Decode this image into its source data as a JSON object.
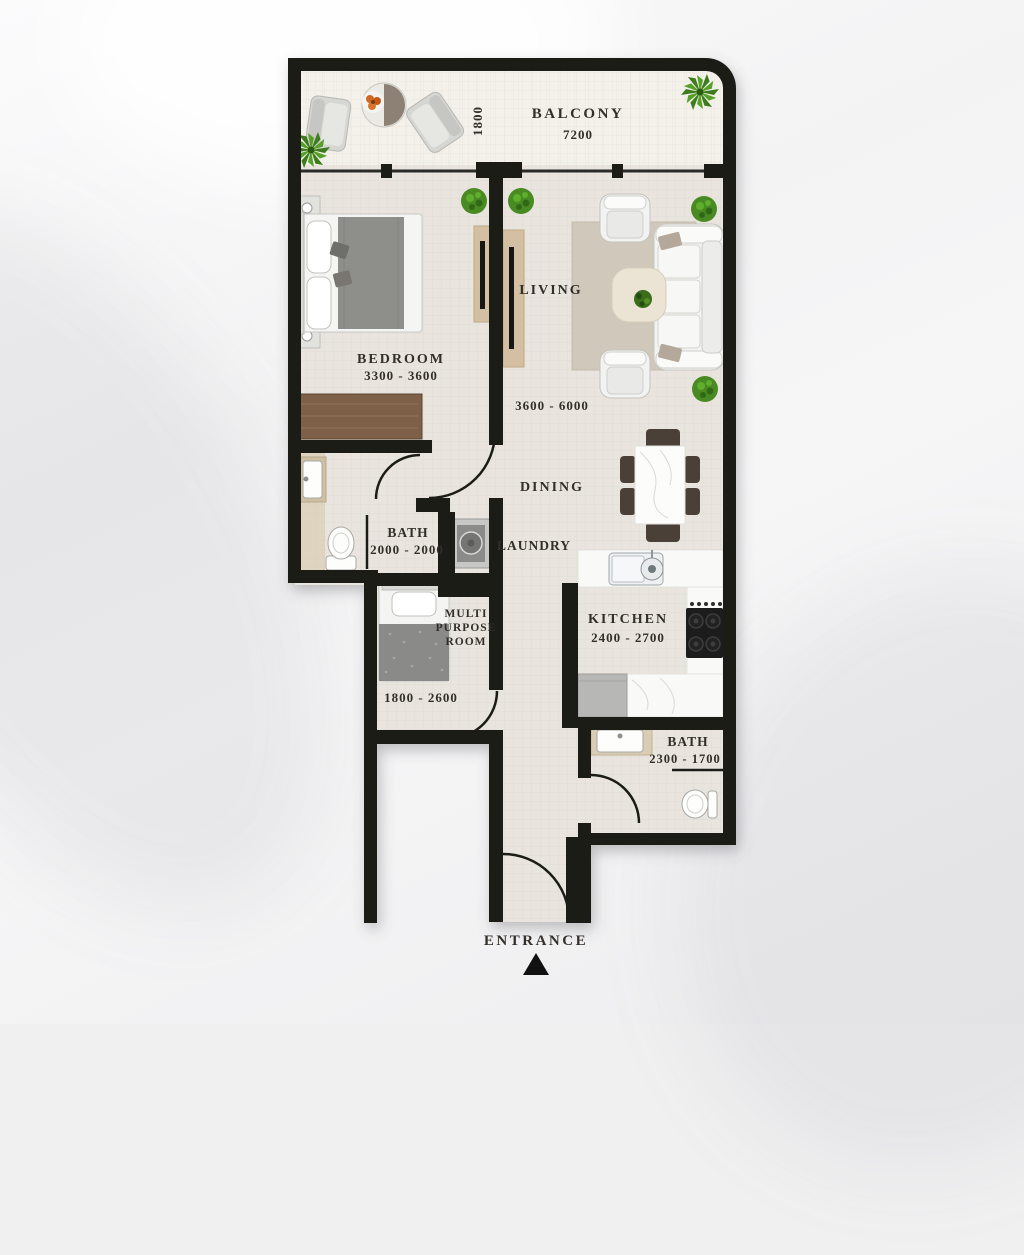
{
  "plan": {
    "type": "apartment-floor-plan",
    "colors": {
      "wall": "#1c1b19",
      "floor": "#e9e5de",
      "balcony_floor": "#f3f1ea",
      "rug": "#d0c8bb",
      "wood": "#7d6147",
      "tv_unit": "#d5bfa3",
      "text": "#332f2a",
      "plant": "#3d7b1a",
      "counter": "#f9f9f7"
    },
    "rooms": {
      "balcony": {
        "name": "BALCONY",
        "width_dim": "7200",
        "depth_dim": "1800"
      },
      "bedroom": {
        "name": "BEDROOM",
        "dim": "3300 - 3600"
      },
      "living": {
        "name": "LIVING",
        "dim": "3600 - 6000"
      },
      "dining": {
        "name": "DINING"
      },
      "bath1": {
        "name": "BATH",
        "dim": "2000 - 2000"
      },
      "laundry": {
        "name": "LAUNDRY"
      },
      "multipurpose": {
        "lines": [
          "MULTI",
          "PURPOSE",
          "ROOM"
        ],
        "dim": "1800 - 2600"
      },
      "kitchen": {
        "name": "KITCHEN",
        "dim": "2400 - 2700"
      },
      "bath2": {
        "name": "BATH",
        "dim": "2300 - 1700"
      },
      "entrance": {
        "name": "ENTRANCE"
      }
    }
  }
}
